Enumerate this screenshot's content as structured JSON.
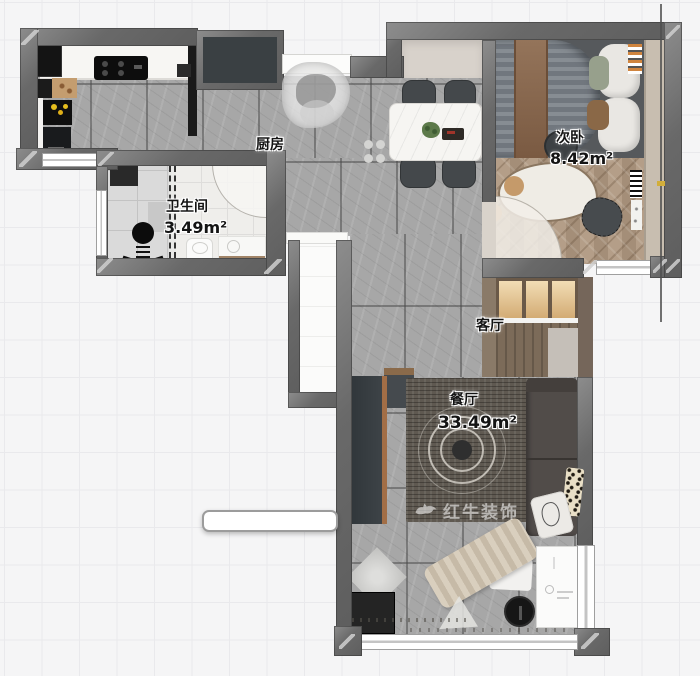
{
  "plan": {
    "rooms": {
      "kitchen": {
        "label": "厨房"
      },
      "bathroom": {
        "label": "卫生间",
        "area": "3.49m²"
      },
      "second_bedroom": {
        "label": "次卧",
        "area": "8.42m²"
      },
      "living_room": {
        "label": "客厅"
      },
      "dining_room": {
        "label": "餐厅",
        "area": "33.49m²"
      }
    },
    "watermark": {
      "brand": "红牛装饰"
    },
    "colors": {
      "wall_gray": "#6b6b6b",
      "tile_gray": "#a7a7a7",
      "wood_floor": "#b19b85",
      "cabinet_glow": "#ecd0a0",
      "rug_dark": "#5f5951",
      "background": "#f5f5f6",
      "accent_yellow": "#e6be1e"
    }
  }
}
